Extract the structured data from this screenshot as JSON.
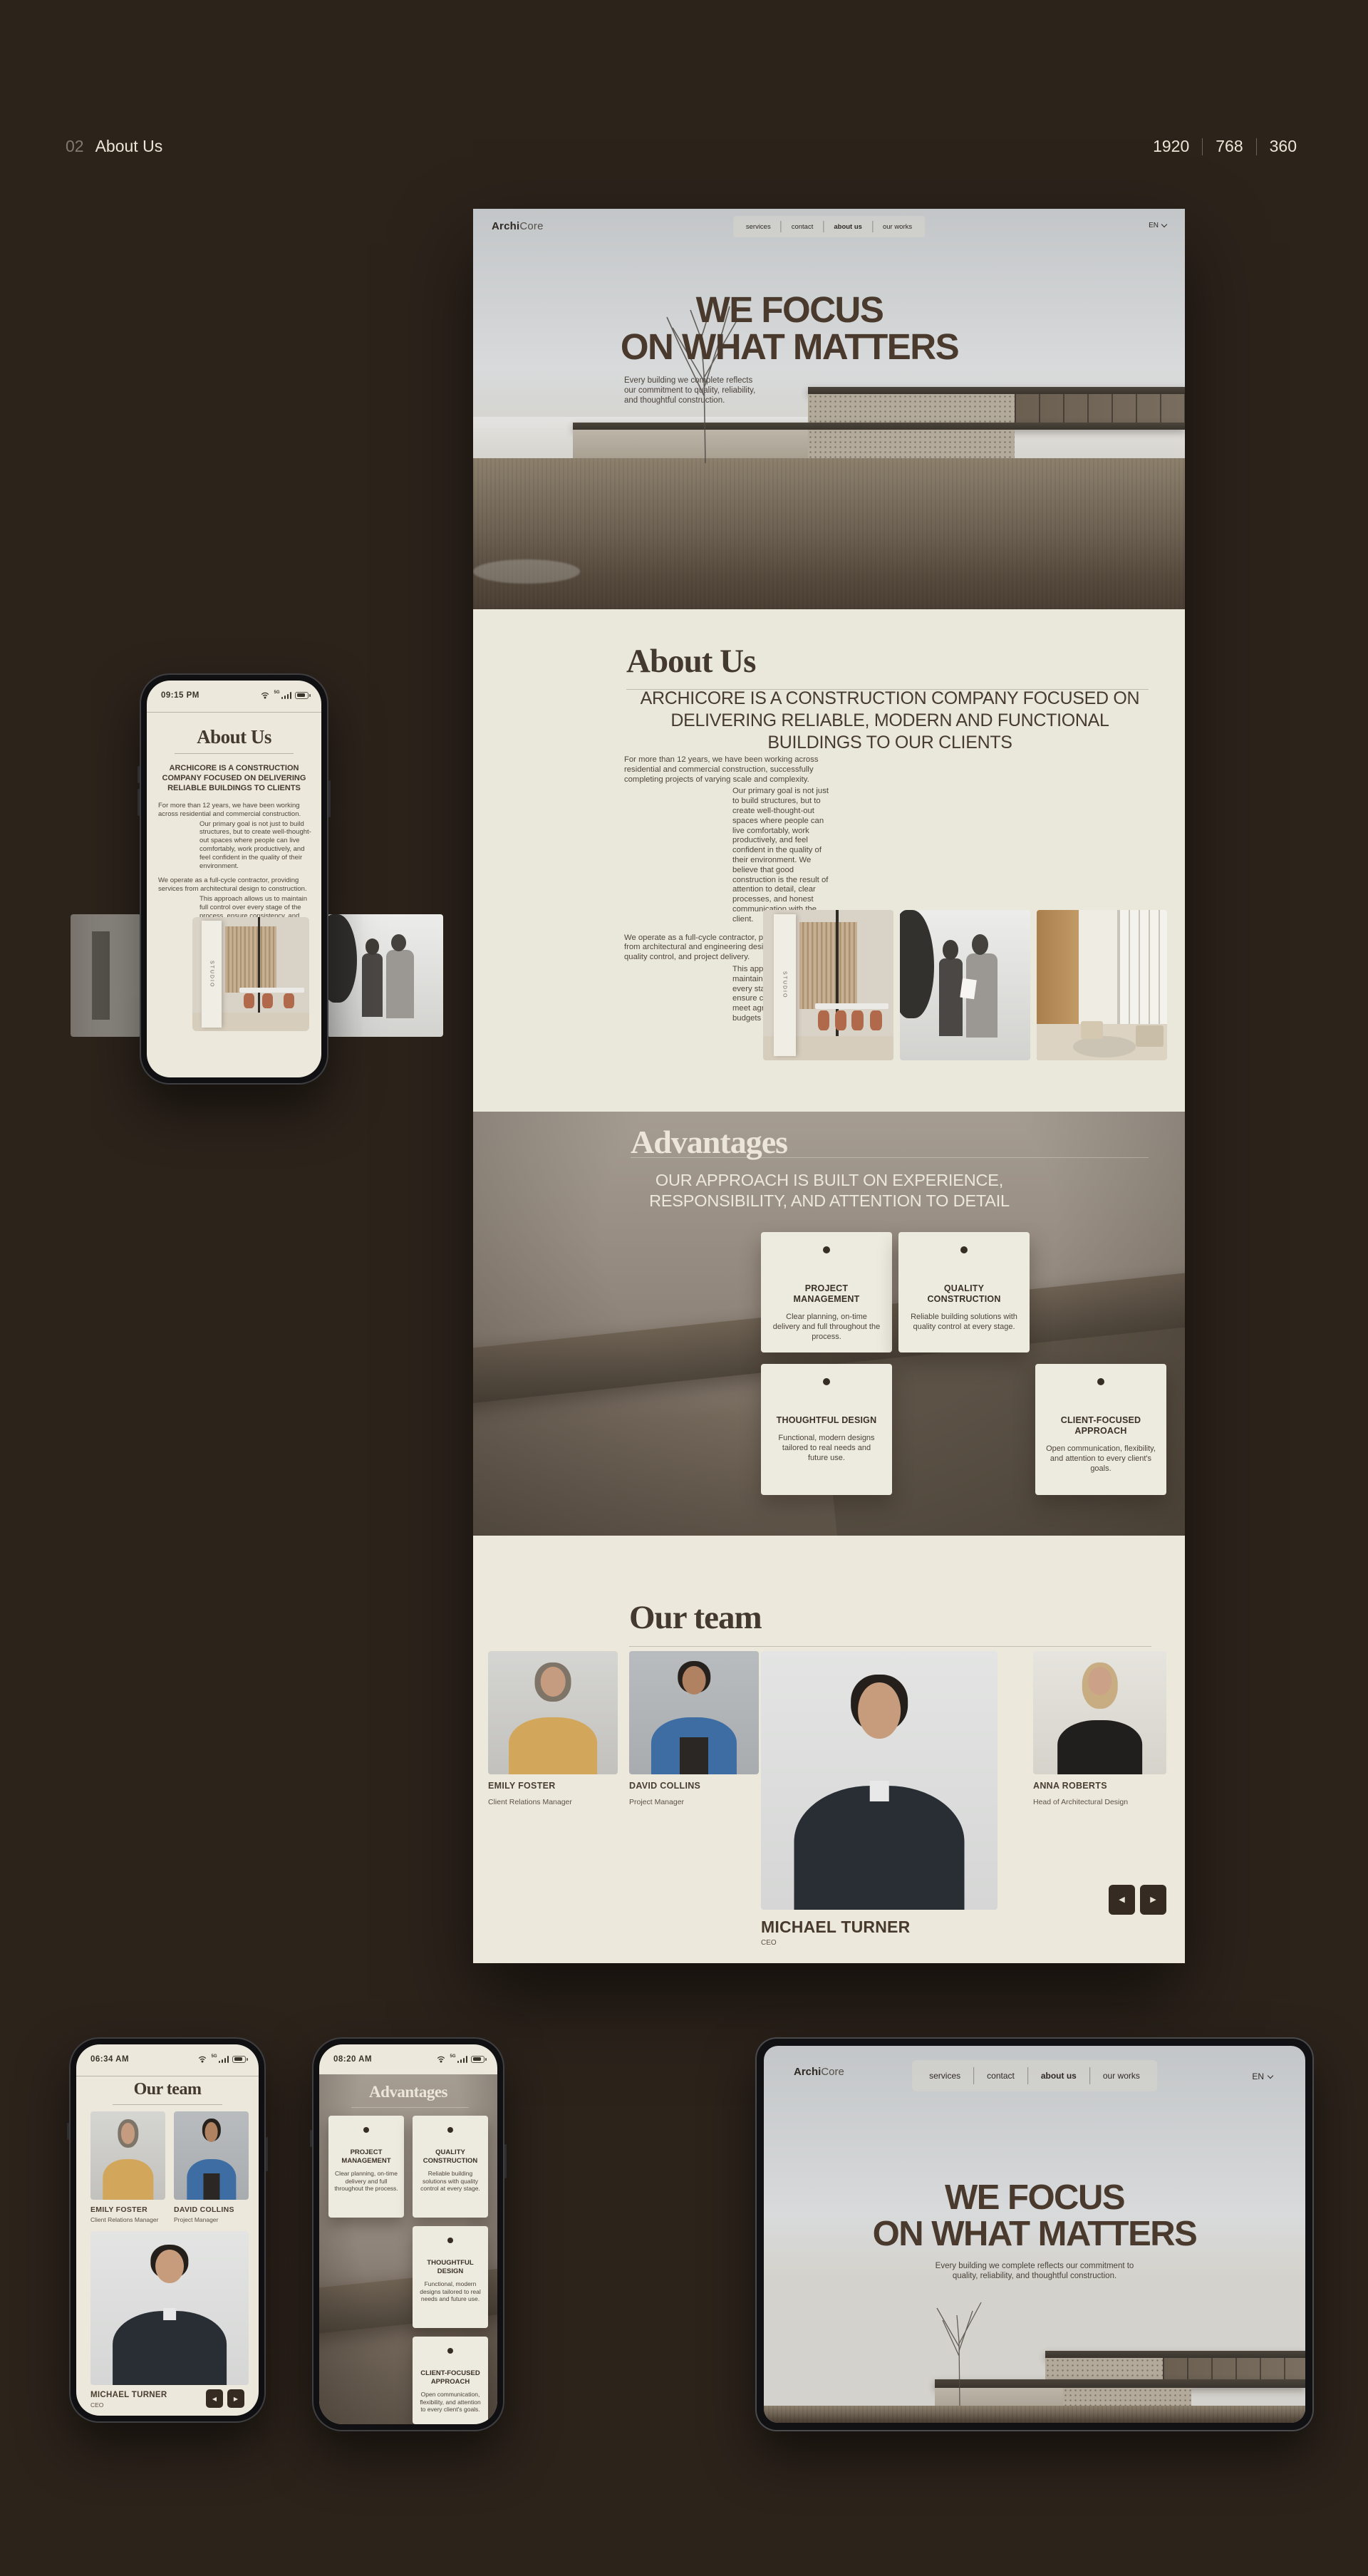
{
  "page": {
    "index": "02",
    "title": "About Us",
    "breakpoints": [
      "1920",
      "768",
      "360"
    ]
  },
  "site": {
    "logo_bold": "Archi",
    "logo_light": "Core",
    "nav": [
      "services",
      "contact",
      "about us",
      "our works"
    ],
    "lang": "EN"
  },
  "status": {
    "network": "5G"
  },
  "hero": {
    "title_line1": "WE FOCUS",
    "title_line2": "ON WHAT MATTERS",
    "description": "Every building we complete reflects our commitment to quality, reliability, and thoughtful construction."
  },
  "about": {
    "heading": "About Us",
    "subheading": "ARCHICORE IS A CONSTRUCTION COMPANY FOCUSED ON DELIVERING RELIABLE, MODERN AND FUNCTIONAL BUILDINGS TO OUR CLIENTS",
    "paragraphs": [
      "For more than 12 years, we have been working across residential and commercial construction, successfully completing projects of varying scale and complexity.",
      "Our primary goal is not just to build structures, but to create well-thought-out spaces where people can live comfortably, work productively, and feel confident in the quality of their environment. We believe that good construction is the result of attention to detail, clear processes, and honest communication with the client.",
      "We operate as a full-cycle contractor, providing services from architectural and engineering design to construction, quality control, and project delivery.",
      "This approach allows us to maintain full control over every stage of the process, ensure consistency, and meet agreed timelines and budgets"
    ],
    "studio_sign": "STUDIO"
  },
  "advantages": {
    "heading": "Advantages",
    "subheading": "OUR APPROACH IS BUILT ON EXPERIENCE, RESPONSIBILITY, AND ATTENTION TO DETAIL",
    "cards": [
      {
        "title": "PROJECT MANAGEMENT",
        "text": "Clear planning, on-time delivery and full throughout the process."
      },
      {
        "title": "QUALITY CONSTRUCTION",
        "text": "Reliable building solutions with quality control at every stage."
      },
      {
        "title": "THOUGHTFUL DESIGN",
        "text": "Functional, modern designs tailored to real needs and future use."
      },
      {
        "title": "CLIENT-FOCUSED APPROACH",
        "text": "Open communication, flexibility, and attention to every client's goals."
      }
    ]
  },
  "team": {
    "heading": "Our team",
    "members": [
      {
        "name": "EMILY FOSTER",
        "role": "Client Relations Manager"
      },
      {
        "name": "DAVID COLLINS",
        "role": "Project Manager"
      },
      {
        "name": "MICHAEL TURNER",
        "role": "CEO"
      },
      {
        "name": "ANNA ROBERTS",
        "role": "Head of Architectural Design"
      }
    ]
  },
  "mobile_about": {
    "time": "09:15 PM",
    "subheading": "ARCHICORE IS A CONSTRUCTION COMPANY FOCUSED ON DELIVERING RELIABLE BUILDINGS TO CLIENTS",
    "paragraphs": [
      "For more than 12 years, we have been working across residential and commercial construction.",
      "Our primary goal is not just to build structures, but to create well-thought-out spaces where people can live comfortably, work productively, and feel confident in the quality of their environment.",
      "We operate as a full-cycle contractor, providing services from architectural design to construction.",
      "This approach allows us to maintain full control over every stage of the process, ensure consistency, and meet agreed timelines and budgets"
    ]
  },
  "mobile_team": {
    "time": "06:34 AM"
  },
  "mobile_advantages": {
    "time": "08:20 AM"
  },
  "carousel": {
    "prev": "◀",
    "next": "▶"
  },
  "colors": {
    "background": "#2c231b",
    "panel": "#eae7db",
    "ink": "#46392e",
    "cream": "#ece8db",
    "card": "#edeadf",
    "accent_dark": "#352b22"
  }
}
